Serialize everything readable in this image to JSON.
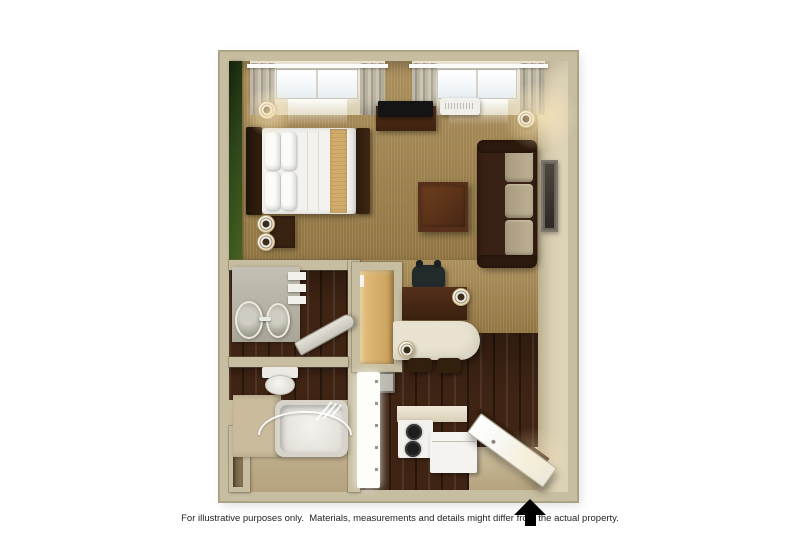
{
  "image": {
    "kind": "3D studio suite floor plan render",
    "view": "top-down"
  },
  "disclaimer": {
    "text": "For illustrative purposes only.  Materials, measurements and details might differ from the actual property."
  },
  "entrance": {
    "indicator": "black up arrow",
    "direction": "up"
  },
  "palette": {
    "background": "#ffffff",
    "wall": "#c7bda0",
    "wall_face": "#e0d4b8",
    "accent_wall_green": "#3c5a1e",
    "carpet": "#a8894f",
    "dark_wood_floor": "#3f2414",
    "bath_floor": "#c9b999",
    "dark_furniture": "#3a2212",
    "sofa_cushion": "#b4a78c",
    "bed_runner": "#d2ac6b",
    "counter_cream": "#e9e2d0",
    "fixture_white": "#f4f3ef",
    "arrow": "#000000"
  },
  "rooms": [
    "bedroom / living area",
    "kitchen",
    "bathroom",
    "vanity area",
    "closet",
    "entry"
  ],
  "furniture": [
    "bed",
    "headboard",
    "pillows",
    "bed runner",
    "footboard",
    "nightstand",
    "table lamps",
    "wall sconce",
    "tv",
    "media console",
    "ptac air-conditioner",
    "two windows with curtains",
    "sofa",
    "coffee table",
    "wall art",
    "floor lamp",
    "desk",
    "desk chair",
    "desk lamp",
    "breakfast counter",
    "counter lamp",
    "bar stools",
    "stove with two burners",
    "refrigerator",
    "kitchen counter",
    "closet shelving",
    "vanity with sink and mirrors",
    "towel shelves",
    "ironing board",
    "toilet",
    "bathtub",
    "shower curtain rod",
    "open entry door"
  ]
}
